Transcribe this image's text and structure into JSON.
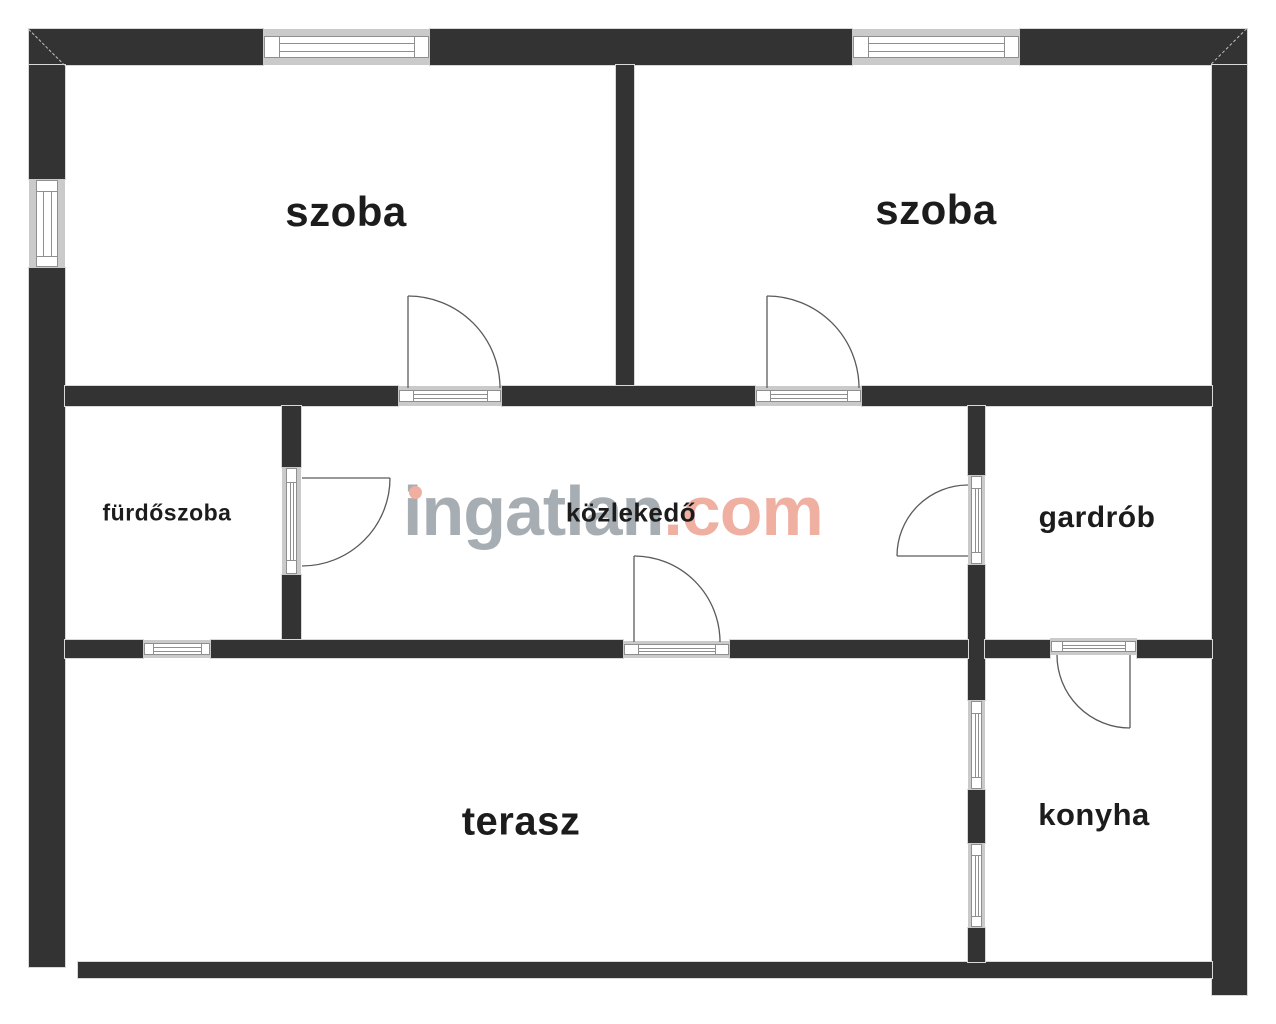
{
  "watermark": {
    "brand": "ingatlan",
    "tld": ".com"
  },
  "colors": {
    "wall": "#333333",
    "wall_outline": "#d8d8d8",
    "window_frame_gray": "#cacaca",
    "window_line": "#8f8f8f",
    "door_line": "#5a5a5a",
    "label_text": "#1c1c1c",
    "watermark_gray": "#98a0a6",
    "watermark_accent": "#eda291",
    "background": "#ffffff"
  },
  "rooms": [
    {
      "id": "szoba-left",
      "label": "szoba",
      "cx": 346,
      "cy": 212,
      "size": 42
    },
    {
      "id": "szoba-right",
      "label": "szoba",
      "cx": 936,
      "cy": 210,
      "size": 42
    },
    {
      "id": "furdoszoba",
      "label": "fürdőszoba",
      "cx": 167,
      "cy": 513,
      "size": 23
    },
    {
      "id": "kozlekedo",
      "label": "közlekedő",
      "cx": 631,
      "cy": 513,
      "size": 26
    },
    {
      "id": "gardrob",
      "label": "gardrób",
      "cx": 1097,
      "cy": 518,
      "size": 30
    },
    {
      "id": "terasz",
      "label": "terasz",
      "cx": 521,
      "cy": 822,
      "size": 40
    },
    {
      "id": "konyha",
      "label": "konyha",
      "cx": 1094,
      "cy": 815,
      "size": 31
    }
  ],
  "plan": {
    "width": 1276,
    "height": 1024,
    "walls": [
      {
        "id": "top-wall-left",
        "x": 29,
        "y": 29,
        "w": 234,
        "h": 36
      },
      {
        "id": "top-wall-middle",
        "x": 430,
        "y": 29,
        "w": 422,
        "h": 36
      },
      {
        "id": "top-wall-right",
        "x": 1020,
        "y": 29,
        "w": 227,
        "h": 36
      },
      {
        "id": "left-wall-upper",
        "x": 29,
        "y": 65,
        "w": 36,
        "h": 114
      },
      {
        "id": "left-wall-lower",
        "x": 29,
        "y": 268,
        "w": 36,
        "h": 699
      },
      {
        "id": "right-wall",
        "x": 1212,
        "y": 65,
        "w": 35,
        "h": 930
      },
      {
        "id": "bottom-wall",
        "x": 78,
        "y": 962,
        "w": 1134,
        "h": 16
      },
      {
        "id": "szoba-divider-wall",
        "x": 616,
        "y": 65,
        "w": 18,
        "h": 321
      },
      {
        "id": "mid-wall-1-left",
        "x": 65,
        "y": 386,
        "w": 333,
        "h": 20
      },
      {
        "id": "mid-wall-1-center",
        "x": 502,
        "y": 386,
        "w": 253,
        "h": 20
      },
      {
        "id": "mid-wall-1-right",
        "x": 862,
        "y": 386,
        "w": 350,
        "h": 20
      },
      {
        "id": "furdoszoba-wall-upper",
        "x": 282,
        "y": 406,
        "w": 19,
        "h": 61
      },
      {
        "id": "furdoszoba-wall-lower",
        "x": 282,
        "y": 575,
        "w": 19,
        "h": 65
      },
      {
        "id": "gardrob-wall-upper",
        "x": 968,
        "y": 406,
        "w": 17,
        "h": 69
      },
      {
        "id": "gardrob-wall-mid",
        "x": 968,
        "y": 565,
        "w": 17,
        "h": 135
      },
      {
        "id": "konyha-wall-mid",
        "x": 968,
        "y": 790,
        "w": 17,
        "h": 53
      },
      {
        "id": "konyha-wall-lower",
        "x": 968,
        "y": 928,
        "w": 17,
        "h": 34
      },
      {
        "id": "mid-wall-2-a",
        "x": 65,
        "y": 640,
        "w": 78,
        "h": 18
      },
      {
        "id": "mid-wall-2-b",
        "x": 211,
        "y": 640,
        "w": 412,
        "h": 18
      },
      {
        "id": "mid-wall-2-c",
        "x": 730,
        "y": 640,
        "w": 238,
        "h": 18
      },
      {
        "id": "mid-wall-2-d",
        "x": 985,
        "y": 640,
        "w": 65,
        "h": 18
      },
      {
        "id": "mid-wall-2-e",
        "x": 1137,
        "y": 640,
        "w": 75,
        "h": 18
      }
    ],
    "miters": [
      {
        "id": "corner-miter-top-left",
        "x": 29,
        "y": 29,
        "angle": 45,
        "len": 51
      },
      {
        "id": "corner-miter-top-right",
        "x": 1247,
        "y": 29,
        "angle": 135,
        "len": 50
      }
    ],
    "windows": [
      {
        "id": "szoba-left-window",
        "x": 263,
        "y": 29,
        "w": 167,
        "h": 36,
        "o": "h"
      },
      {
        "id": "szoba-right-window",
        "x": 852,
        "y": 29,
        "w": 168,
        "h": 36,
        "o": "h"
      },
      {
        "id": "szoba-left-side-window",
        "x": 29,
        "y": 179,
        "w": 36,
        "h": 89,
        "o": "v"
      },
      {
        "id": "furdoszoba-window",
        "x": 143,
        "y": 640,
        "w": 68,
        "h": 18,
        "o": "h"
      },
      {
        "id": "konyha-window-upper",
        "x": 968,
        "y": 700,
        "w": 17,
        "h": 90,
        "o": "v"
      },
      {
        "id": "konyha-window-lower",
        "x": 968,
        "y": 843,
        "w": 17,
        "h": 85,
        "o": "v"
      }
    ],
    "door_sills": [
      {
        "id": "szoba-left-door-sill",
        "x": 398,
        "y": 386,
        "w": 104,
        "h": 20,
        "o": "h"
      },
      {
        "id": "szoba-right-door-sill",
        "x": 755,
        "y": 386,
        "w": 107,
        "h": 20,
        "o": "h"
      },
      {
        "id": "furdoszoba-door-sill",
        "x": 282,
        "y": 467,
        "w": 19,
        "h": 108,
        "o": "v"
      },
      {
        "id": "gardrob-door-sill",
        "x": 968,
        "y": 475,
        "w": 17,
        "h": 90,
        "o": "v"
      },
      {
        "id": "terasz-door-sill",
        "x": 623,
        "y": 641,
        "w": 107,
        "h": 17,
        "o": "h"
      },
      {
        "id": "konyha-door-sill",
        "x": 1050,
        "y": 638,
        "w": 87,
        "h": 17,
        "o": "h"
      }
    ],
    "doors": [
      {
        "id": "szoba-left-door",
        "leaf": [
          408,
          296,
          408,
          388
        ],
        "arc": "M 408 296 A 92 92 0 0 1 500 388"
      },
      {
        "id": "szoba-right-door",
        "leaf": [
          767,
          296,
          767,
          388
        ],
        "arc": "M 767 296 A 92 92 0 0 1 859 388"
      },
      {
        "id": "furdoszoba-door",
        "leaf": [
          302,
          478,
          390,
          478
        ],
        "arc": "M 390 478 A 88 88 0 0 1 302 566"
      },
      {
        "id": "gardrob-door",
        "leaf": [
          897,
          556,
          968,
          556
        ],
        "arc": "M 897 556 A 71 71 0 0 1 968 485"
      },
      {
        "id": "kozlekedo-terasz-door",
        "leaf": [
          634,
          556,
          634,
          642
        ],
        "arc": "M 634 556 A 86 86 0 0 1 720 642"
      },
      {
        "id": "konyha-door",
        "leaf": [
          1130,
          655,
          1130,
          728
        ],
        "arc": "M 1057 655 A 73 73 0 0 0 1130 728"
      }
    ]
  }
}
